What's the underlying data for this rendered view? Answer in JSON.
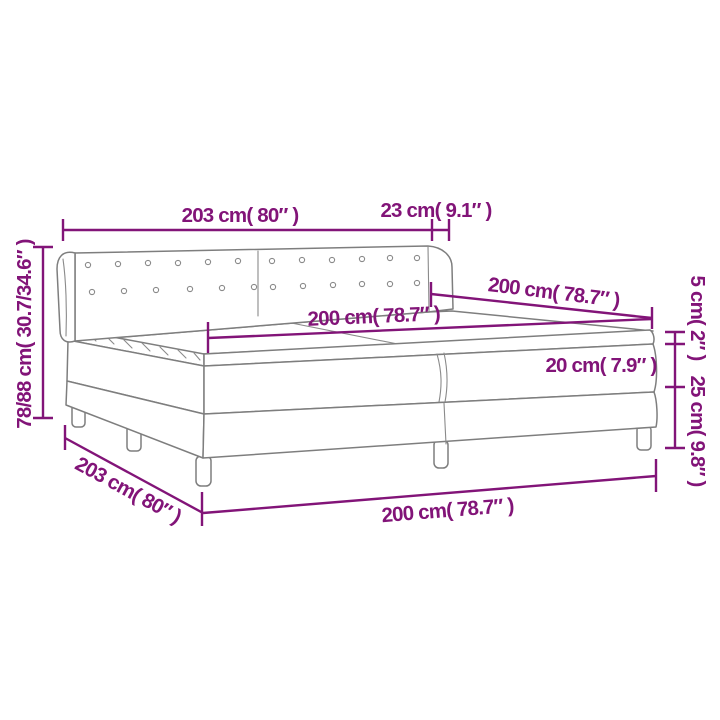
{
  "image": {
    "type": "product-dimension-diagram",
    "subject": "box spring bed with headboard and pillow-top mattress",
    "background_color": "#ffffff",
    "colors": {
      "dimension_annotations": "#821478",
      "product_outline": "#7e7e7e"
    }
  },
  "dimensions": {
    "headboard_width": "203 cm( 80″ )",
    "headboard_depth": "23 cm( 9.1″ )",
    "headboard_height": "78/88 cm( 30.7/34.6″ )",
    "bed_length_top": "200 cm( 78.7″ )",
    "mattress_width": "200 cm( 78.7″ )",
    "pillow_top_height": "5 cm( 2″ )",
    "mattress_height": "20 cm( 7.9″ )",
    "base_height": "25 cm( 9.8″ )",
    "base_length_side": "203 cm( 80″ )",
    "bed_width_bottom": "200 cm( 78.7″ )"
  }
}
